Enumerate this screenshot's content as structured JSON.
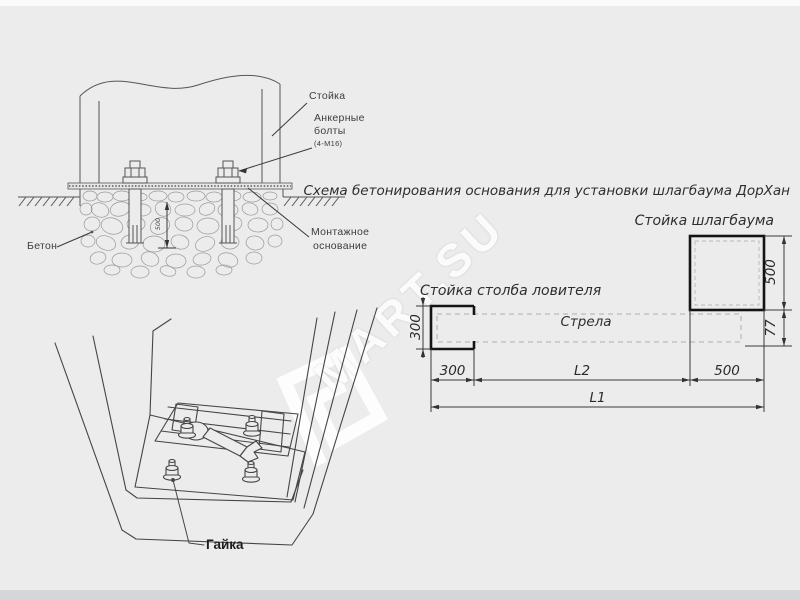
{
  "watermark": {
    "text": "MART.SU"
  },
  "section_drawing": {
    "labels": {
      "post": "Стойка",
      "anchor_bolts_line1": "Анкерные",
      "anchor_bolts_line2": "болты",
      "anchor_bolts_spec": "(4-М16)",
      "concrete": "Бетон",
      "mounting_base_line1": "Монтажное",
      "mounting_base_line2": "основание"
    },
    "dimensions": {
      "depth": "500"
    }
  },
  "pit_drawing": {
    "labels": {
      "nut": "Гайка"
    }
  },
  "plan_diagram": {
    "title": "Схема бетонирования основания для установки шлагбаума ДорХан",
    "labels": {
      "barrier_post": "Стойка шлагбаума",
      "catcher_post": "Стойка столба ловителя",
      "boom": "Стрела"
    },
    "dimensions": {
      "catcher_width": "300",
      "catcher_height": "300",
      "barrier_side": "500",
      "barrier_width": "500",
      "boom_offset": "77",
      "span_l2": "L2",
      "total_l1": "L1"
    }
  }
}
